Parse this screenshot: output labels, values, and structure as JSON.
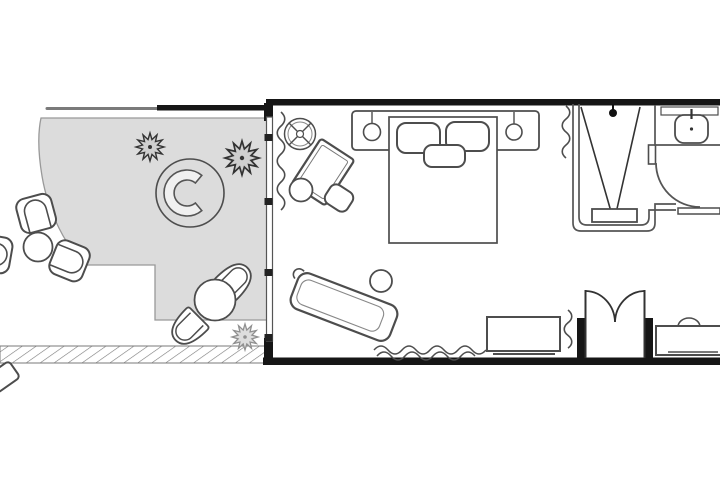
{
  "plan": {
    "colors": {
      "background": "#ffffff",
      "wall": "#161616",
      "line": "#4d4d4d",
      "line_soft": "#8a8a8a",
      "terrace_fill": "#dcdcdc",
      "terrace_edge": "#999999",
      "hatch_line": "#7a7a7a",
      "plant_fill": "#cfcfcf",
      "plant_light_fill": "#dddddd",
      "bench_fill": "#f0f0f0",
      "furniture_fill": "#ffffff"
    }
  }
}
